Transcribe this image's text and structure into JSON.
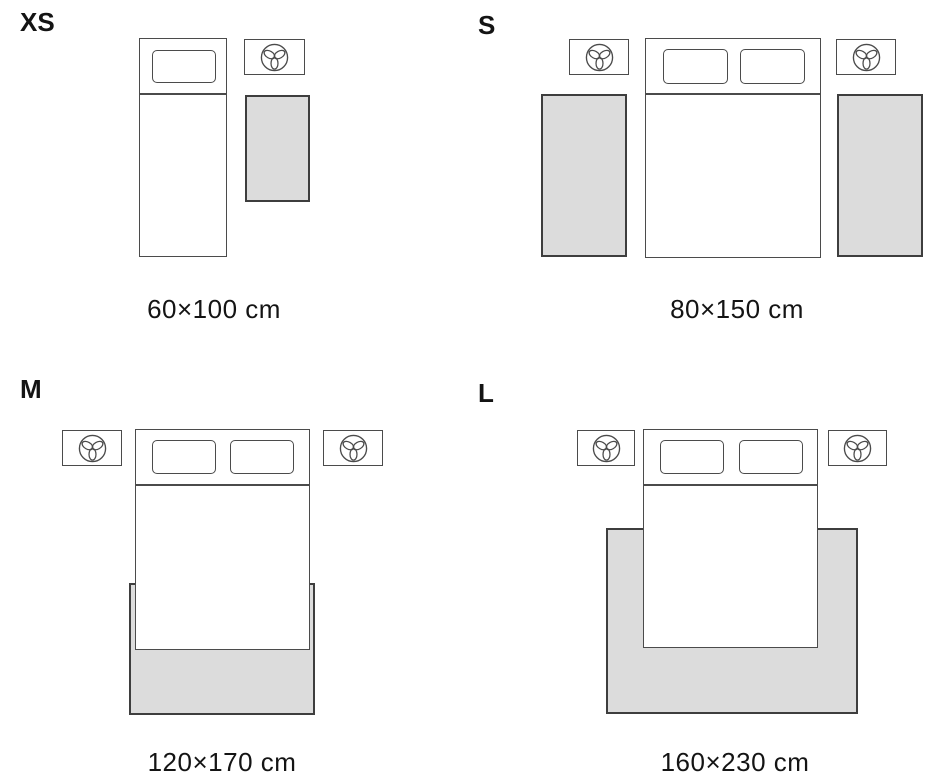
{
  "colors": {
    "background": "#ffffff",
    "line": "#4b4b4b",
    "rug_border": "#3e3e3e",
    "rug_fill": "#dcdcdc",
    "text": "#141414"
  },
  "icons": {
    "nightstand_item": "plant-icon"
  },
  "sizes": [
    {
      "code": "XS",
      "dimensions": "60×100 cm"
    },
    {
      "code": "S",
      "dimensions": "80×150 cm"
    },
    {
      "code": "M",
      "dimensions": "120×170 cm"
    },
    {
      "code": "L",
      "dimensions": "160×230 cm"
    }
  ]
}
